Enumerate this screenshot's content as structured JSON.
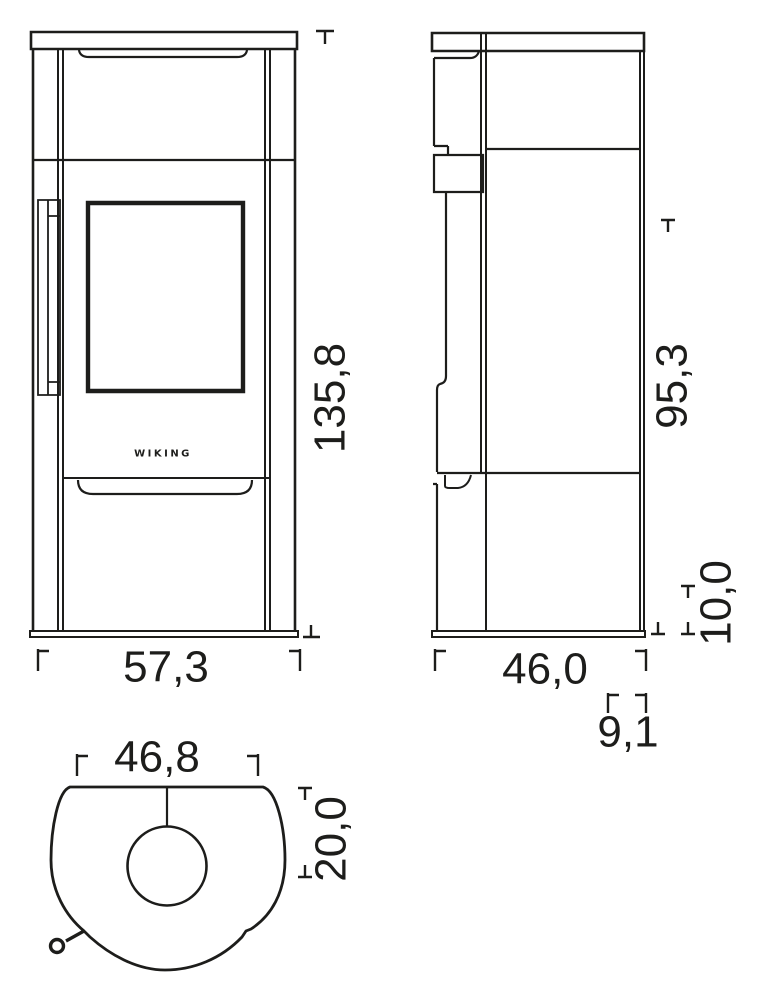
{
  "drawing": {
    "brand_logo": "WIKING",
    "dimensions": {
      "front_height": "135,8",
      "front_width": "57,3",
      "side_height": "95,3",
      "side_base_height": "10,0",
      "side_depth": "46,0",
      "side_flue_offset": "9,1",
      "top_width": "46,8",
      "top_flue_center_depth": "20,0"
    },
    "colors": {
      "line": "#1d1d1b",
      "background": "#ffffff"
    }
  }
}
